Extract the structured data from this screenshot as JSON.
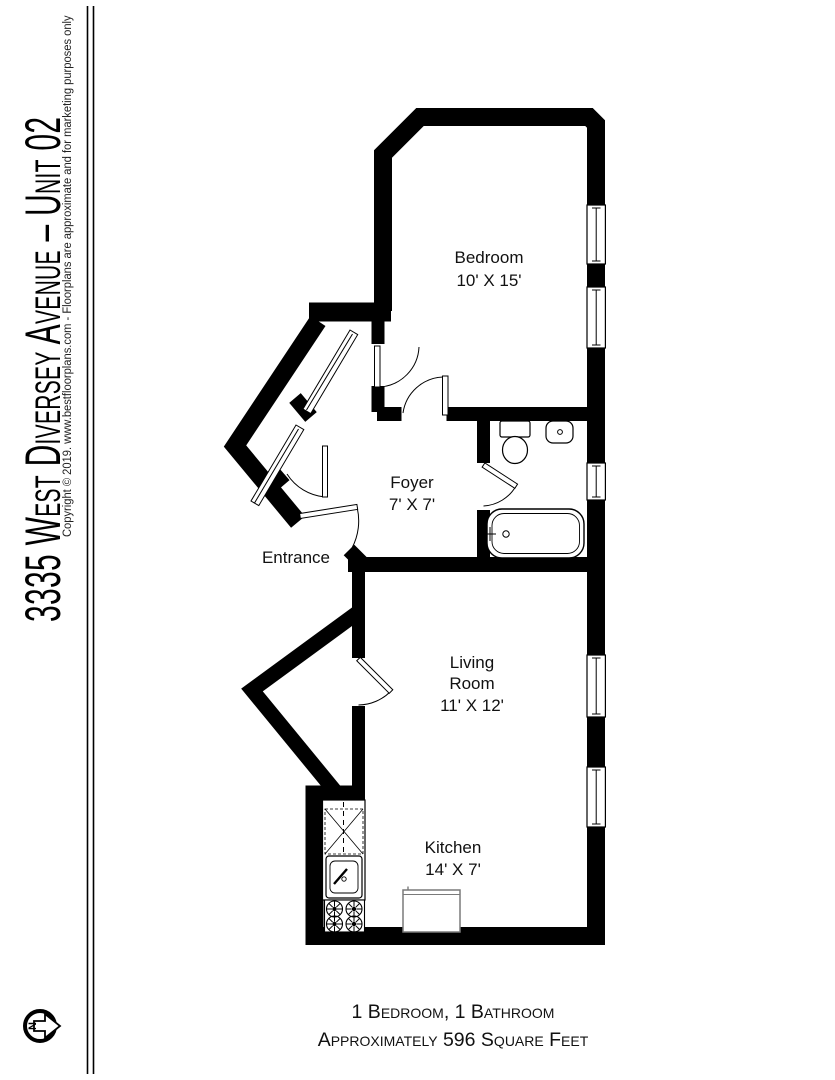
{
  "title_block": {
    "title": "3335 West Diversey Avenue – Unit 02",
    "copyright": "Copyright © 2019. www.bestfloorplans.com - Floorplans are approximate and for marketing purposes only"
  },
  "rooms": {
    "bedroom": {
      "name": "Bedroom",
      "dims": "10' X 15'"
    },
    "foyer": {
      "name": "Foyer",
      "dims": "7' X 7'"
    },
    "entrance": {
      "label": "Entrance"
    },
    "living_room": {
      "name_line1": "Living",
      "name_line2": "Room",
      "dims": "11' X 12'"
    },
    "kitchen": {
      "name": "Kitchen",
      "dims": "14' X 7'"
    }
  },
  "summary": {
    "line1": "1 Bedroom, 1 Bathroom",
    "line2": "Approximately 596 Square Feet"
  },
  "compass": {
    "north_label": "N"
  },
  "colors": {
    "wall": "#000000",
    "background": "#ffffff",
    "text": "#111111"
  }
}
